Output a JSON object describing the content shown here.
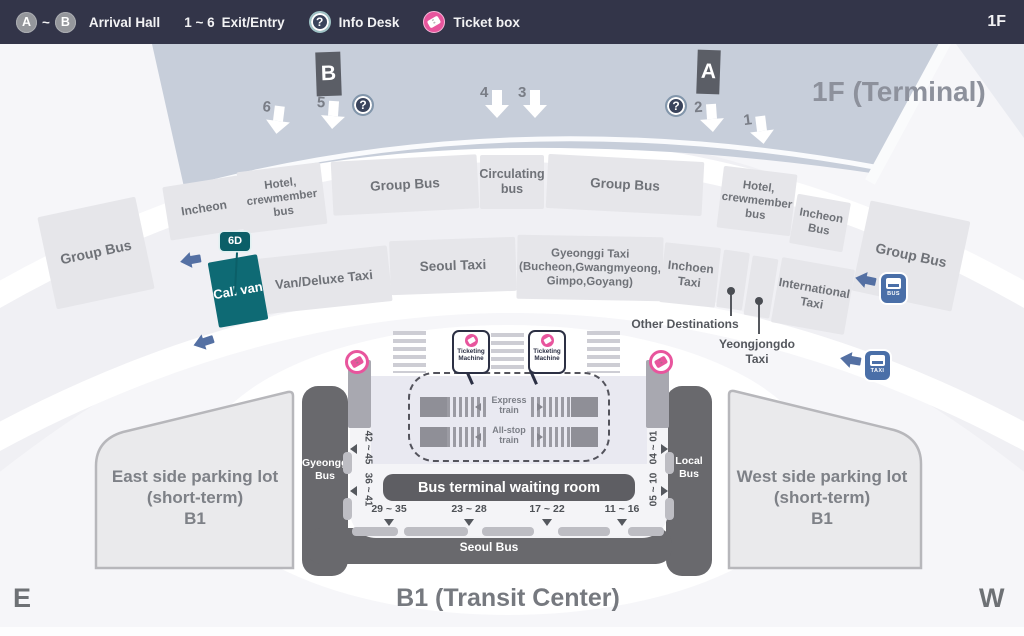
{
  "legend": {
    "a": "A",
    "tilde": "~",
    "b": "B",
    "arrival": "Arrival Hall",
    "exit_range": "1 ~ 6",
    "exit": "Exit/Entry",
    "question": "?",
    "info": "Info Desk",
    "ticket": "Ticket box",
    "floor": "1F"
  },
  "terminal": {
    "title": "1F (Terminal)",
    "marker_b": "B",
    "marker_a": "A",
    "question": "?",
    "exits": [
      "6",
      "5",
      "4",
      "3",
      "2",
      "1"
    ]
  },
  "zones": {
    "row1": [
      "Group Bus",
      "Incheon",
      "Hotel, crewmember bus",
      "Group Bus",
      "Circulating bus",
      "Group Bus",
      "Hotel, crewmember bus",
      "Incheon Bus",
      "Group Bus"
    ],
    "badge_6d": "6D",
    "call_van": "Call van",
    "van_deluxe": "Van/Deluxe Taxi",
    "seoul_taxi": "Seoul Taxi",
    "gyeonggi_l1": "Gyeonggi Taxi",
    "gyeonggi_l2": "(Bucheon,Gwangmyeong,",
    "gyeonggi_l3": "Gimpo,Goyang)",
    "inchoen_taxi": "Inchoen Taxi",
    "international_taxi": "International Taxi",
    "other_destinations": "Other Destinations",
    "yeongjongdo_taxi": "Yeongjongdo Taxi"
  },
  "transit": {
    "ticketing_machine": "Ticketing Machine",
    "express_train": "Express train",
    "all_stop_train": "All-stop train",
    "waiting_room": "Bus terminal waiting room",
    "gyeonggi_bus": "Gyeonggi Bus",
    "local_bus": "Local Bus",
    "seoul_bus": "Seoul Bus",
    "stops_bottom": [
      "29 ~ 35",
      "23 ~ 28",
      "17 ~ 22",
      "11 ~ 16"
    ],
    "stops_left": [
      "42 ~ 45",
      "36 ~ 41"
    ],
    "stops_right": [
      "04 ~ 01",
      "05 ~ 10"
    ],
    "icon_bus_label": "BUS",
    "icon_taxi_label": "TAXI"
  },
  "parking": {
    "east_line1": "East side parking lot",
    "east_line2": "(short-term)",
    "east_line3": "B1",
    "west_line1": "West side parking lot",
    "west_line2": "(short-term)",
    "west_line3": "B1"
  },
  "footer": {
    "title": "B1 (Transit Center)",
    "east": "E",
    "west": "W"
  },
  "colors": {
    "pink": "#e8559d",
    "teal": "#0e6a74",
    "blue": "#5470a3",
    "navy": "#333549",
    "band": "#c7ceda",
    "road": "#69696d"
  }
}
